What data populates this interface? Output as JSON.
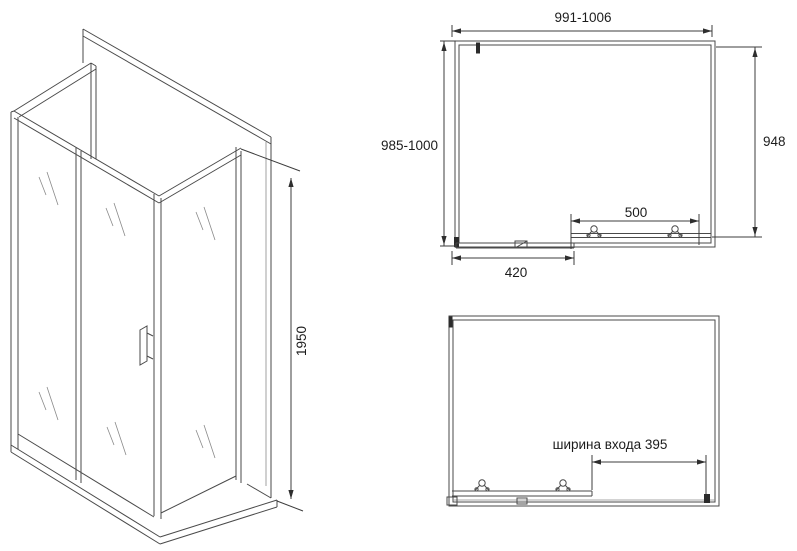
{
  "colors": {
    "background": "#ffffff",
    "line": "#4a4a4a",
    "dimension_line": "#3c3c3c",
    "text": "#1c1c1c"
  },
  "iso_view": {
    "height_dim": "1950"
  },
  "plan_top_view": {
    "width_dim": "991-1006",
    "depth_dim": "985-1000",
    "side_panel_dim": "948",
    "fixed_panel_dim": "500",
    "door_panel_dim": "420"
  },
  "plan_open_door_view": {
    "entrance_width_dim": "ширина входа 395"
  },
  "icons": {
    "roller": "door-roller-wheel"
  }
}
